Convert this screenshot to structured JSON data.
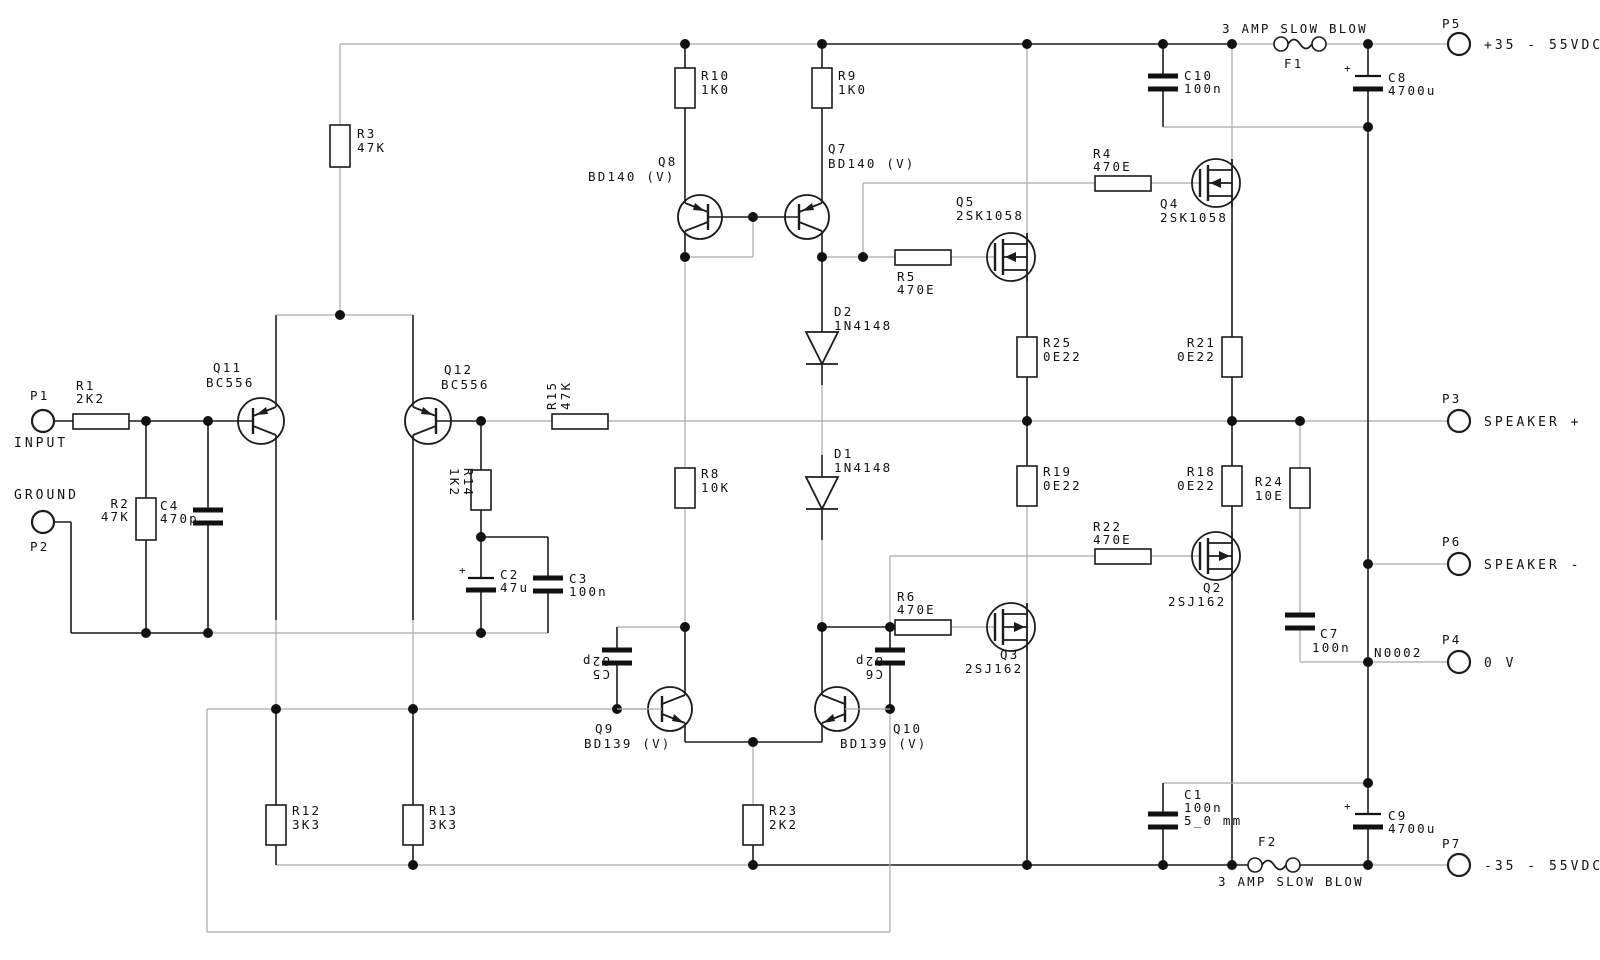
{
  "schematic": {
    "plus": "+",
    "net_labels": {
      "n0002": "N0002"
    },
    "connectors": {
      "p1": {
        "name": "P1",
        "label": "INPUT"
      },
      "p2": {
        "name": "P2",
        "label": "GROUND"
      },
      "p3": {
        "name": "P3",
        "label": "SPEAKER +"
      },
      "p4": {
        "name": "P4",
        "label": "0 V"
      },
      "p5": {
        "name": "P5",
        "label": "+35 - 55VDC"
      },
      "p6": {
        "name": "P6",
        "label": "SPEAKER -"
      },
      "p7": {
        "name": "P7",
        "label": "-35 - 55VDC"
      }
    },
    "fuses": {
      "f1": {
        "name": "F1",
        "rating": "3 AMP SLOW BLOW"
      },
      "f2": {
        "name": "F2",
        "rating": "3 AMP SLOW BLOW"
      }
    },
    "resistors": {
      "r1": {
        "ref": "R1",
        "val": "2K2"
      },
      "r2": {
        "ref": "R2",
        "val": "47K"
      },
      "r3": {
        "ref": "R3",
        "val": "47K"
      },
      "r4": {
        "ref": "R4",
        "val": "470E"
      },
      "r5": {
        "ref": "R5",
        "val": "470E"
      },
      "r6": {
        "ref": "R6",
        "val": "470E"
      },
      "r8": {
        "ref": "R8",
        "val": "10K"
      },
      "r9": {
        "ref": "R9",
        "val": "1K0"
      },
      "r10": {
        "ref": "R10",
        "val": "1K0"
      },
      "r12": {
        "ref": "R12",
        "val": "3K3"
      },
      "r13": {
        "ref": "R13",
        "val": "3K3"
      },
      "r14": {
        "ref": "R14",
        "val": "1K2"
      },
      "r15": {
        "ref": "R15",
        "val": "47K"
      },
      "r18": {
        "ref": "R18",
        "val": "0E22"
      },
      "r19": {
        "ref": "R19",
        "val": "0E22"
      },
      "r21": {
        "ref": "R21",
        "val": "0E22"
      },
      "r22": {
        "ref": "R22",
        "val": "470E"
      },
      "r23": {
        "ref": "R23",
        "val": "2K2"
      },
      "r24": {
        "ref": "R24",
        "val": "10E"
      },
      "r25": {
        "ref": "R25",
        "val": "0E22"
      }
    },
    "capacitors": {
      "c1": {
        "ref": "C1",
        "val": "100n",
        "note": "5_0 mm"
      },
      "c2": {
        "ref": "C2",
        "val": "47u"
      },
      "c3": {
        "ref": "C3",
        "val": "100n"
      },
      "c4": {
        "ref": "C4",
        "val": "470p"
      },
      "c5": {
        "ref": "C5",
        "val": "82p"
      },
      "c6": {
        "ref": "C6",
        "val": "82p"
      },
      "c7": {
        "ref": "C7",
        "val": "100n"
      },
      "c8": {
        "ref": "C8",
        "val": "4700u"
      },
      "c9": {
        "ref": "C9",
        "val": "4700u"
      },
      "c10": {
        "ref": "C10",
        "val": "100n"
      }
    },
    "diodes": {
      "d1": {
        "ref": "D1",
        "part": "1N4148"
      },
      "d2": {
        "ref": "D2",
        "part": "1N4148"
      }
    },
    "transistors": {
      "q2": {
        "ref": "Q2",
        "part": "2SJ162"
      },
      "q3": {
        "ref": "Q3",
        "part": "2SJ162"
      },
      "q4": {
        "ref": "Q4",
        "part": "2SK1058"
      },
      "q5": {
        "ref": "Q5",
        "part": "2SK1058"
      },
      "q7": {
        "ref": "Q7",
        "part": "BD140 (V)"
      },
      "q8": {
        "ref": "Q8",
        "part": "BD140 (V)"
      },
      "q9": {
        "ref": "Q9",
        "part": "BD139 (V)"
      },
      "q10": {
        "ref": "Q10",
        "part": "BD139 (V)"
      },
      "q11": {
        "ref": "Q11",
        "part": "BC556"
      },
      "q12": {
        "ref": "Q12",
        "part": "BC556"
      }
    }
  }
}
